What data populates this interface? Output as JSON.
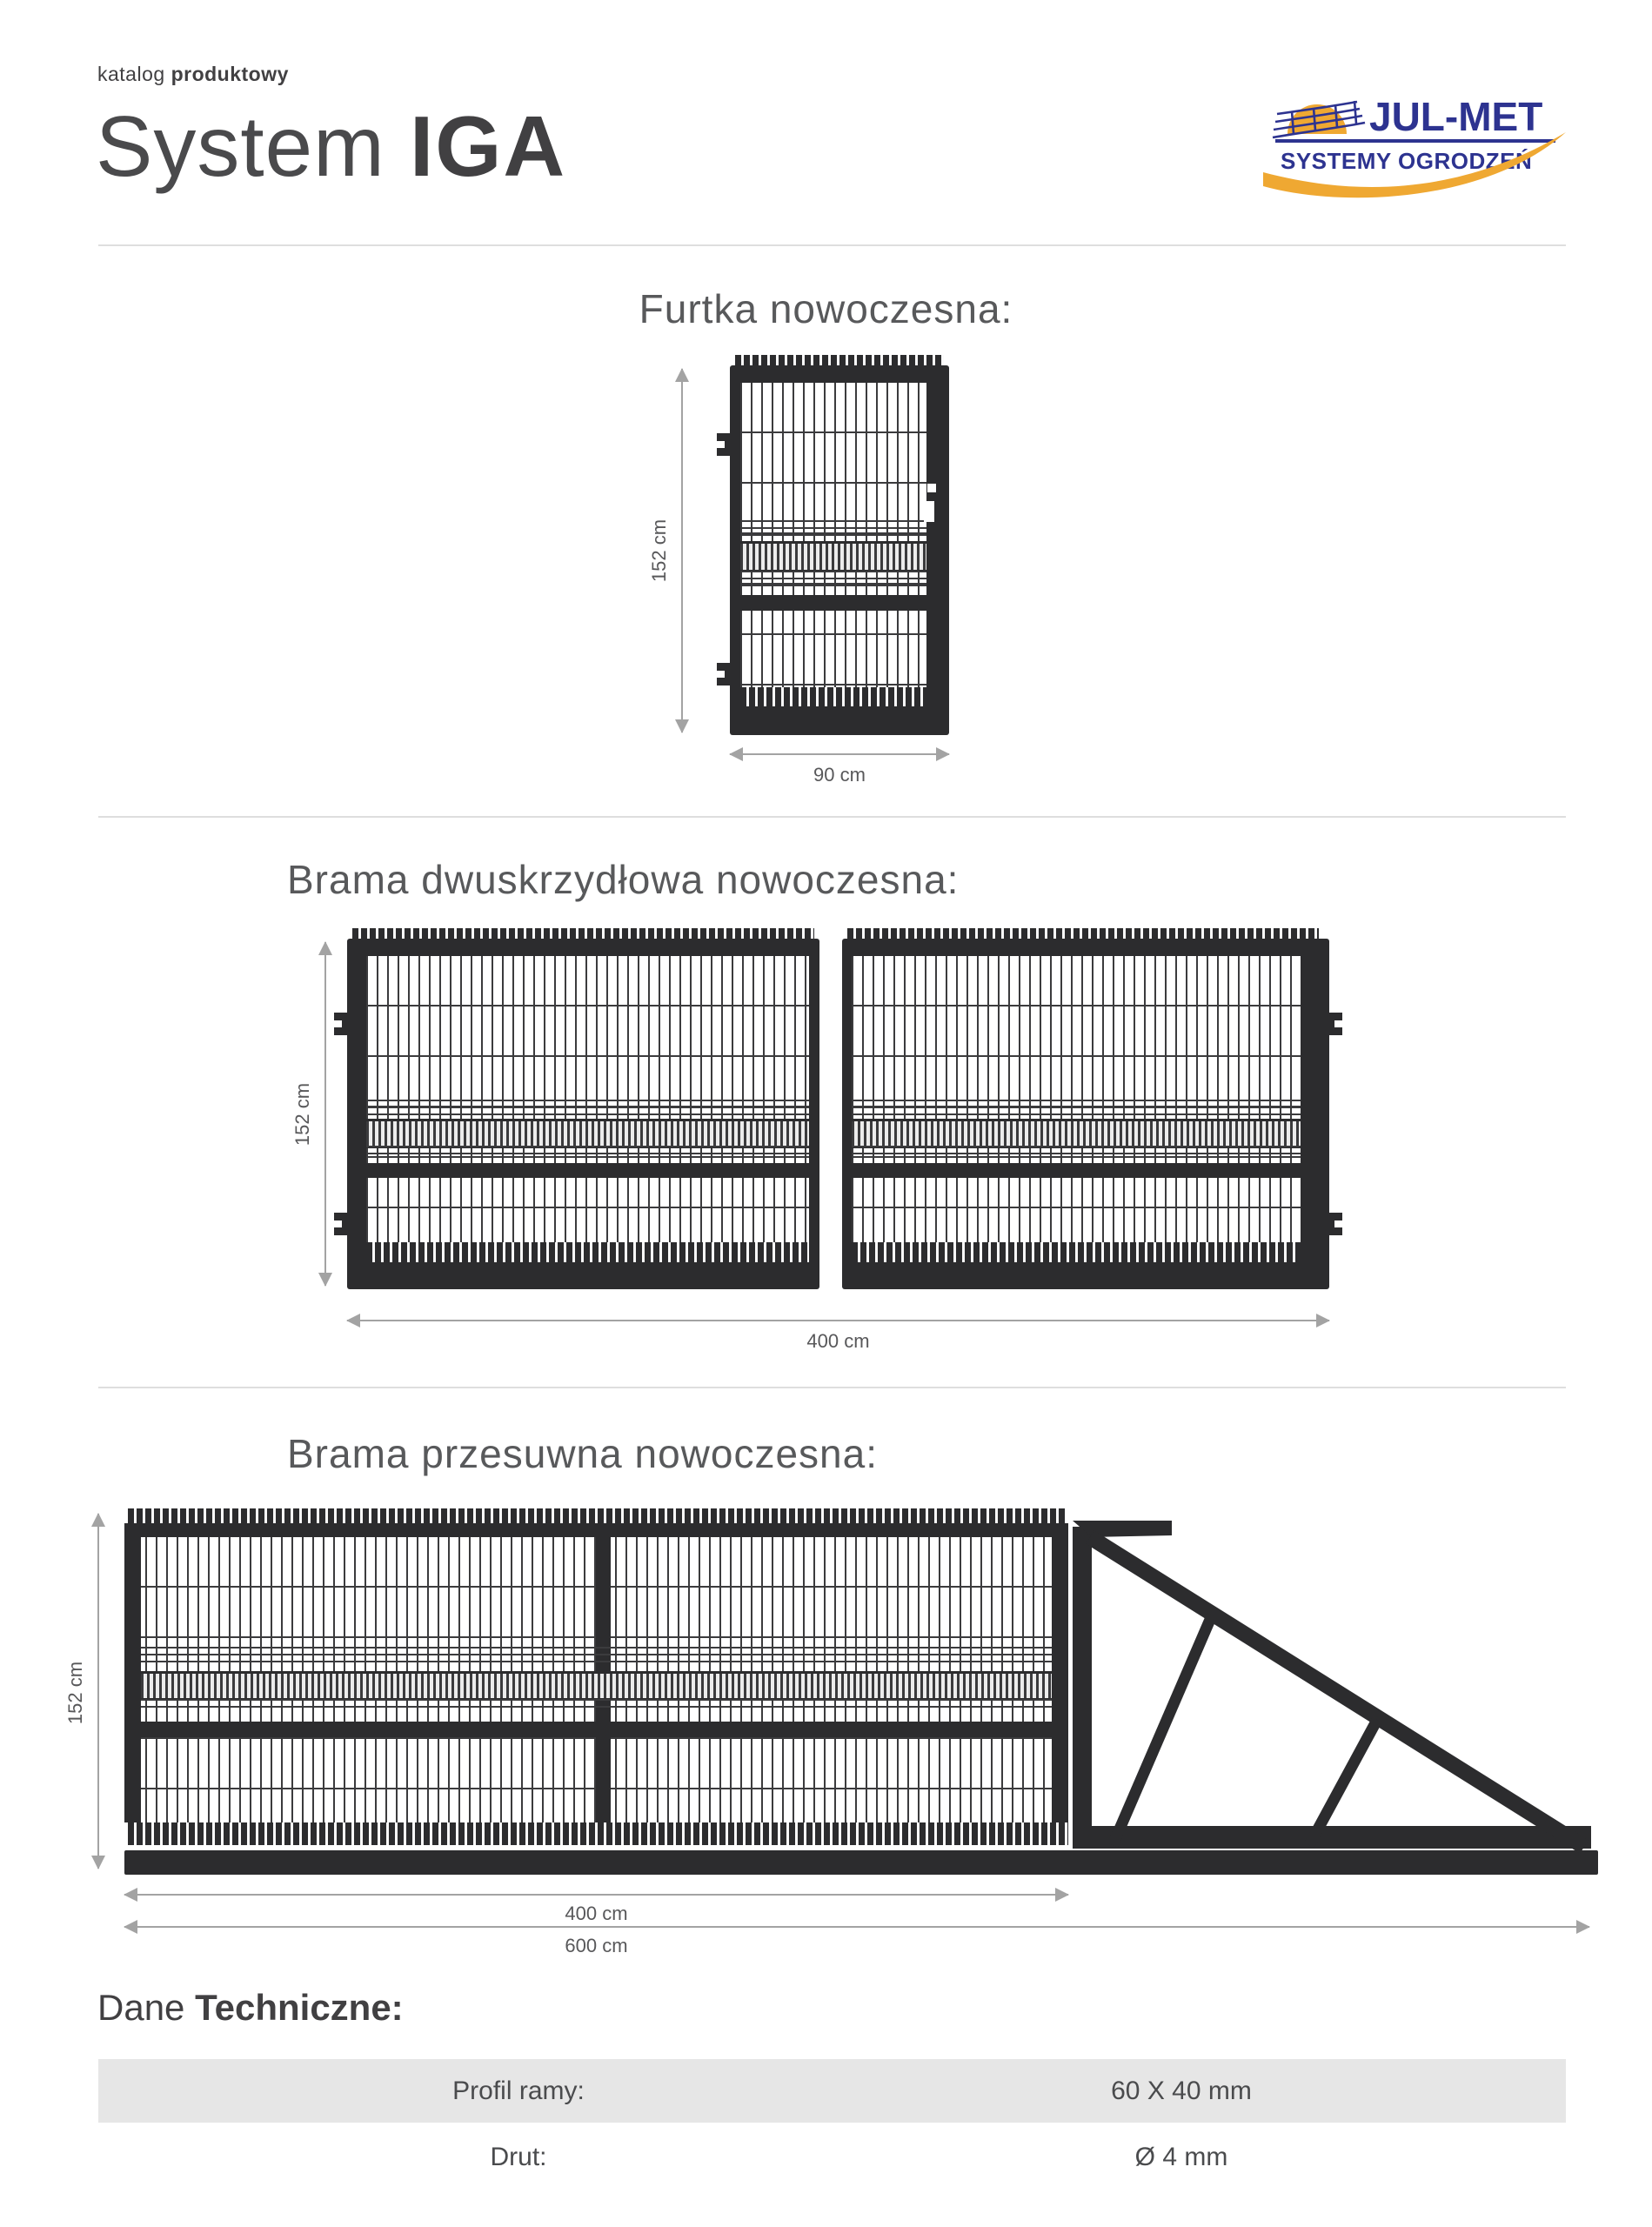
{
  "header": {
    "kicker_light": "katalog",
    "kicker_bold": "produktowy",
    "title_light": "System",
    "title_bold": "IGA"
  },
  "logo": {
    "name": "JUL-MET",
    "subtitle": "SYSTEMY OGRODZEŃ",
    "navy": "#2d3390",
    "orange": "#efa832"
  },
  "sections": {
    "wicket": {
      "title": "Furtka nowoczesna:",
      "height_label": "152 cm",
      "width_label": "90 cm"
    },
    "double_swing": {
      "title": "Brama dwuskrzydłowa nowoczesna:",
      "height_label": "152 cm",
      "width_label": "400 cm"
    },
    "sliding": {
      "title": "Brama przesuwna nowoczesna:",
      "height_label": "152 cm",
      "width_gate_label": "400 cm",
      "width_total_label": "600 cm"
    }
  },
  "tech": {
    "heading_light": "Dane",
    "heading_bold": "Techniczne:",
    "rows": [
      {
        "label": "Profil ramy:",
        "value": "60 X 40 mm"
      },
      {
        "label": "Drut:",
        "value": "Ø 4 mm"
      }
    ]
  },
  "colors": {
    "frame": "#2c2c2e",
    "dim_line": "#a3a3a3",
    "row_bg": "#e6e6e6",
    "logo_navy": "#2d3390",
    "logo_orange": "#efa832"
  }
}
